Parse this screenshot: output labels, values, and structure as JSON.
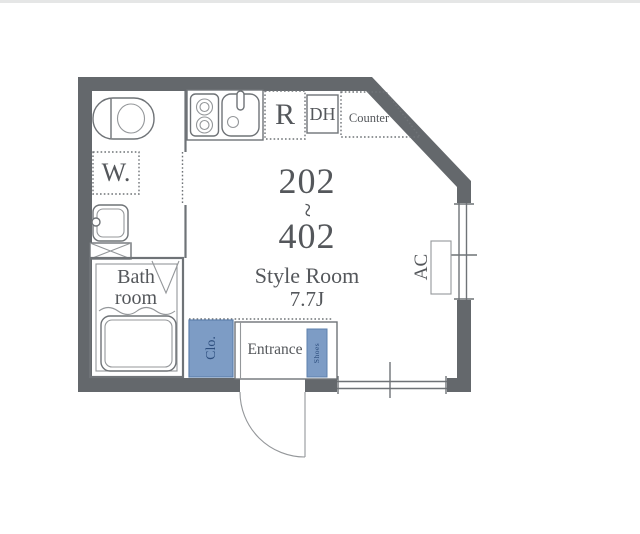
{
  "colors": {
    "wall": "#64686c",
    "line": "#6f7377",
    "accent_blue_fill": "#7d9cc5",
    "accent_blue_border": "#5d80ad",
    "accent_blue_text": "#2d4e7e",
    "text": "#54575b"
  },
  "plan": {
    "units": {
      "first": "202",
      "separator": "~",
      "last": "402"
    },
    "room_name": "Style Room",
    "room_size": "7.7J",
    "rooms": {
      "bathroom": "Bath room",
      "entrance": "Entrance",
      "closet": "Clo.",
      "shoes": "Shoes"
    },
    "fixtures": {
      "washer": "W.",
      "fridge": "R",
      "dh": "DH",
      "counter": "Counter",
      "aircon": "AC"
    }
  }
}
